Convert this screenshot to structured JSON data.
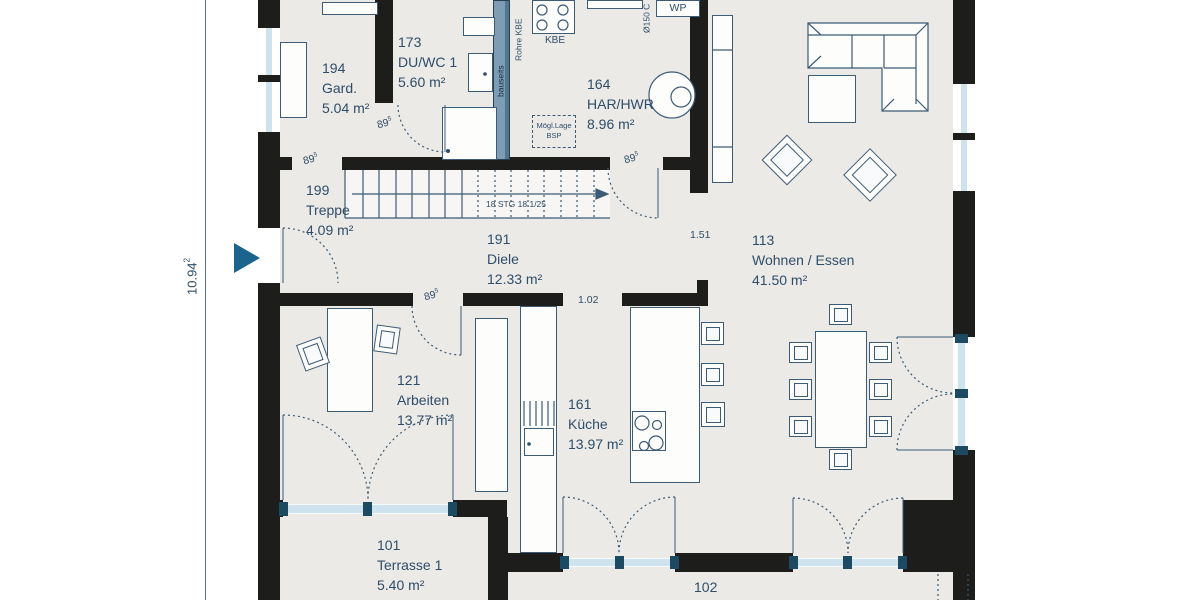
{
  "plan_title": "Erdgeschoss Grundriss",
  "colors": {
    "wall": "#1d1d1b",
    "floor": "#eceae7",
    "line": "#3d5b74",
    "text": "#2e4d68",
    "glass": "#cfe3ef",
    "shaft": "#7e9cb4",
    "accent": "#1a648e"
  },
  "rooms": [
    {
      "id": "194",
      "name": "Gard.",
      "area": "5.04 m²"
    },
    {
      "id": "173",
      "name": "DU/WC 1",
      "area": "5.60 m²"
    },
    {
      "id": "164",
      "name": "HAR/HWR",
      "area": "8.96 m²"
    },
    {
      "id": "199",
      "name": "Treppe",
      "area": "4.09 m²"
    },
    {
      "id": "191",
      "name": "Diele",
      "area": "12.33 m²"
    },
    {
      "id": "113",
      "name": "Wohnen / Essen",
      "area": "41.50 m²"
    },
    {
      "id": "121",
      "name": "Arbeiten",
      "area": "13.77 m²"
    },
    {
      "id": "161",
      "name": "Küche",
      "area": "13.97 m²"
    },
    {
      "id": "101",
      "name": "Terrasse 1",
      "area": "5.40 m²"
    },
    {
      "id": "102",
      "name": "Terrasse 2",
      "area": ""
    }
  ],
  "dims": {
    "height_total": {
      "value": "10.94",
      "sup": "2"
    },
    "door": {
      "value": "89",
      "sup": "5"
    },
    "opening_living": "1.51",
    "opening_kitchen": "1.02"
  },
  "stair_note": "18 STG 18.1/25",
  "tech": {
    "kbe": "KBE",
    "rohre_kbe": "Rohre KBE",
    "shaft_vertical": "bauseits",
    "duct": "Ø150 C",
    "wp": "WP",
    "wws": "WWS",
    "mag": "MAG",
    "bsp1": "Mögl.Lage",
    "bsp2": "BSP"
  }
}
